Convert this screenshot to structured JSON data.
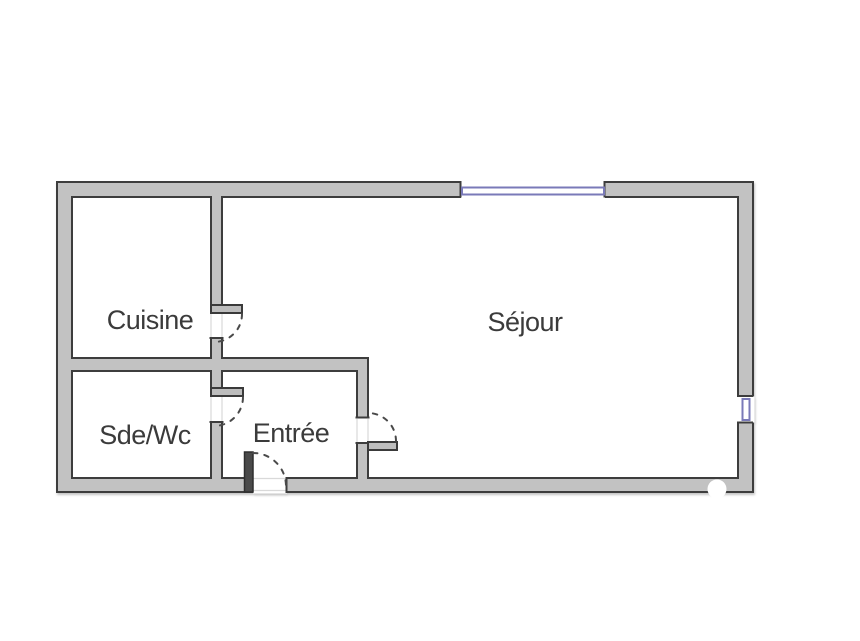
{
  "floor_plan": {
    "rooms": [
      {
        "id": "cuisine",
        "label": "Cuisine"
      },
      {
        "id": "sejour",
        "label": "Séjour"
      },
      {
        "id": "sde_wc",
        "label": "Sde/Wc"
      },
      {
        "id": "entree",
        "label": "Entrée"
      }
    ],
    "door_count": 4,
    "window_count": 2,
    "colors": {
      "wall_fill": "#c2c2c2",
      "wall_outline": "#3d3d3d",
      "window_frame": "#7a7ab8",
      "label_text": "#3b3b3b",
      "background": "#ffffff"
    }
  }
}
